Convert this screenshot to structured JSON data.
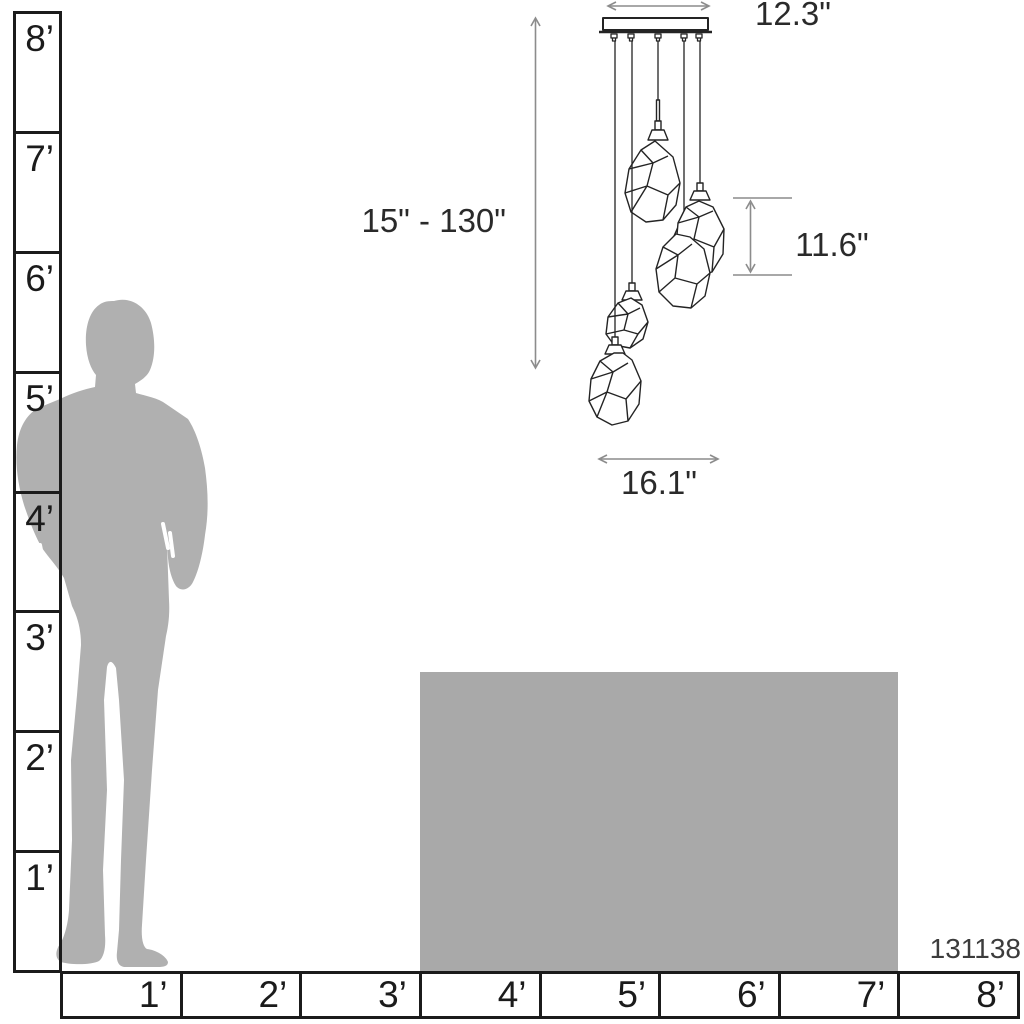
{
  "diagram": {
    "title": "Pendant light mounting height size diagram",
    "product_number": "131138",
    "dimensions": {
      "canopy_width": "12.3\"",
      "height_range": "15\" - 130\"",
      "shade_height": "11.6\"",
      "fixture_width": "16.1\""
    },
    "rulers": {
      "left": {
        "unit": "feet",
        "labels": [
          "8’",
          "7’",
          "6’",
          "5’",
          "4’",
          "3’",
          "2’",
          "1’"
        ]
      },
      "bottom": {
        "unit": "feet",
        "labels": [
          "1’",
          "2’",
          "3’",
          "4’",
          "5’",
          "6’",
          "7’",
          "8’"
        ]
      }
    },
    "graphics": {
      "person": "person-silhouette",
      "table": "table-block",
      "fixture": "five-light-faceted-glass-cluster-pendant"
    },
    "colors": {
      "silhouette_gray": "#b0b0b0",
      "table_gray": "#a9a9a9",
      "dimension_gray": "#8c8c8c",
      "line_black": "#242424",
      "ruler_black": "#1b1b1b",
      "text_dark": "#2a2a2a"
    }
  }
}
